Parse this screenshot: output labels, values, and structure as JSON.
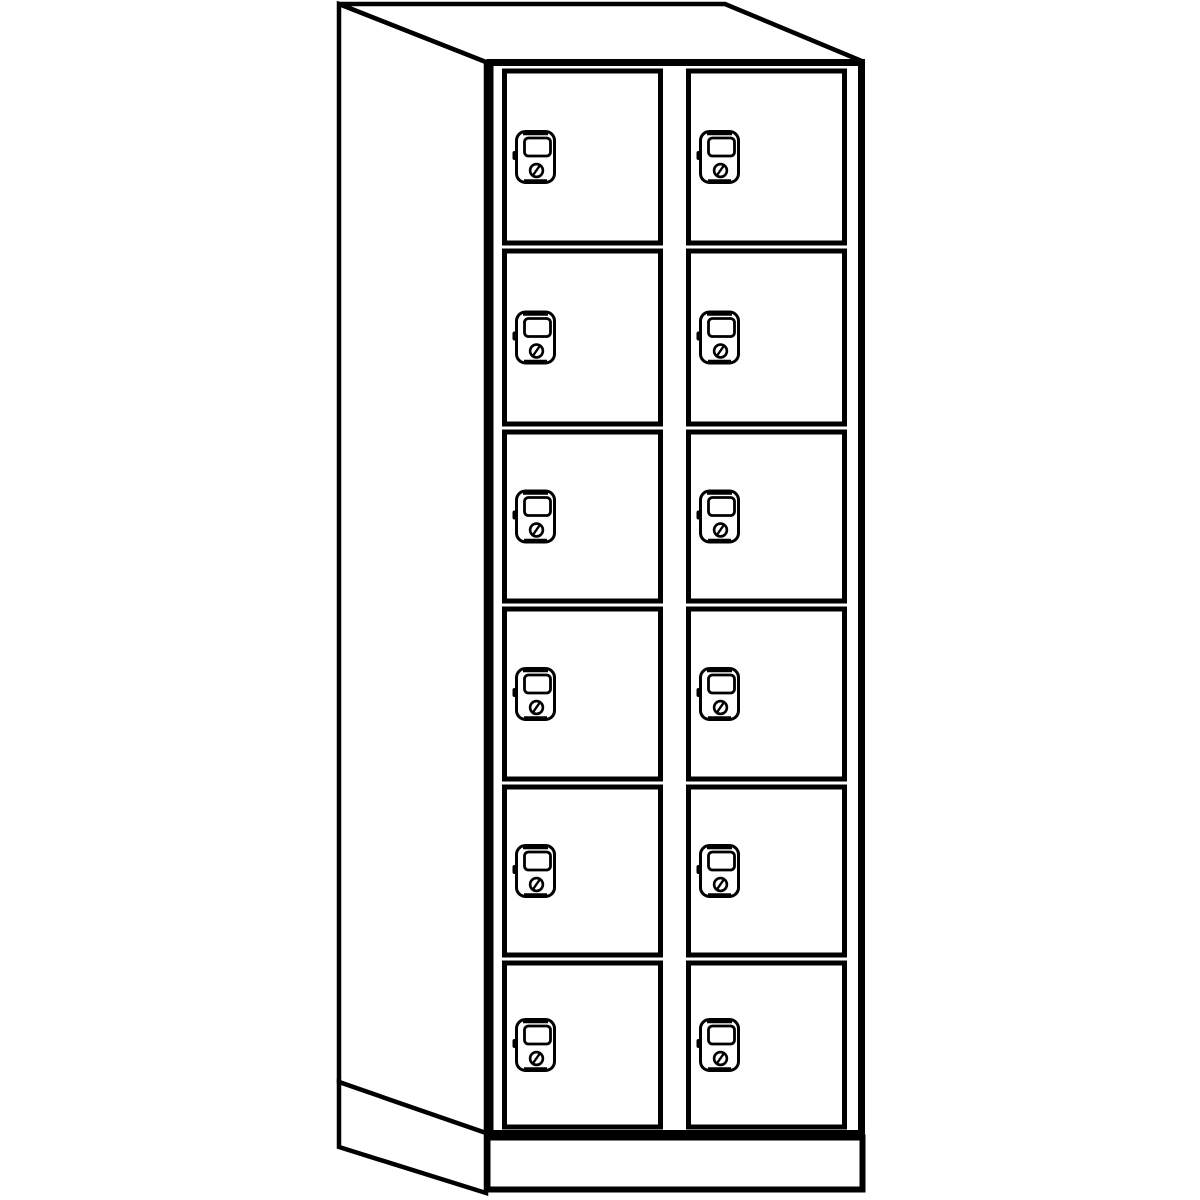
{
  "page": {
    "background_color": "#ffffff"
  },
  "figure": {
    "name": "locker-cabinet-line-drawing",
    "description": "Monochrome perspective line drawing of a tall locker cabinet standing on a plinth base. The left side panel and top are visible; the front has two columns of six compartment doors, each door fitted with a cylinder cam lock.",
    "style": {
      "line_color": "#000000",
      "fill_color": "#ffffff"
    },
    "columns": 2,
    "rows": 6,
    "total_compartments": 12,
    "icons": {
      "lock": "cam-lock-icon-with-label-window-and-keyhole"
    },
    "lock_parts": [
      "lock-body",
      "label-window",
      "keyhole",
      "key-slot-slash",
      "side-nub"
    ]
  },
  "compartments": [
    {
      "id": "door-c1-r1",
      "column": 1,
      "row": 1
    },
    {
      "id": "door-c2-r1",
      "column": 2,
      "row": 1
    },
    {
      "id": "door-c1-r2",
      "column": 1,
      "row": 2
    },
    {
      "id": "door-c2-r2",
      "column": 2,
      "row": 2
    },
    {
      "id": "door-c1-r3",
      "column": 1,
      "row": 3
    },
    {
      "id": "door-c2-r3",
      "column": 2,
      "row": 3
    },
    {
      "id": "door-c1-r4",
      "column": 1,
      "row": 4
    },
    {
      "id": "door-c2-r4",
      "column": 2,
      "row": 4
    },
    {
      "id": "door-c1-r5",
      "column": 1,
      "row": 5
    },
    {
      "id": "door-c2-r5",
      "column": 2,
      "row": 5
    },
    {
      "id": "door-c1-r6",
      "column": 1,
      "row": 6
    },
    {
      "id": "door-c2-r6",
      "column": 2,
      "row": 6
    }
  ]
}
